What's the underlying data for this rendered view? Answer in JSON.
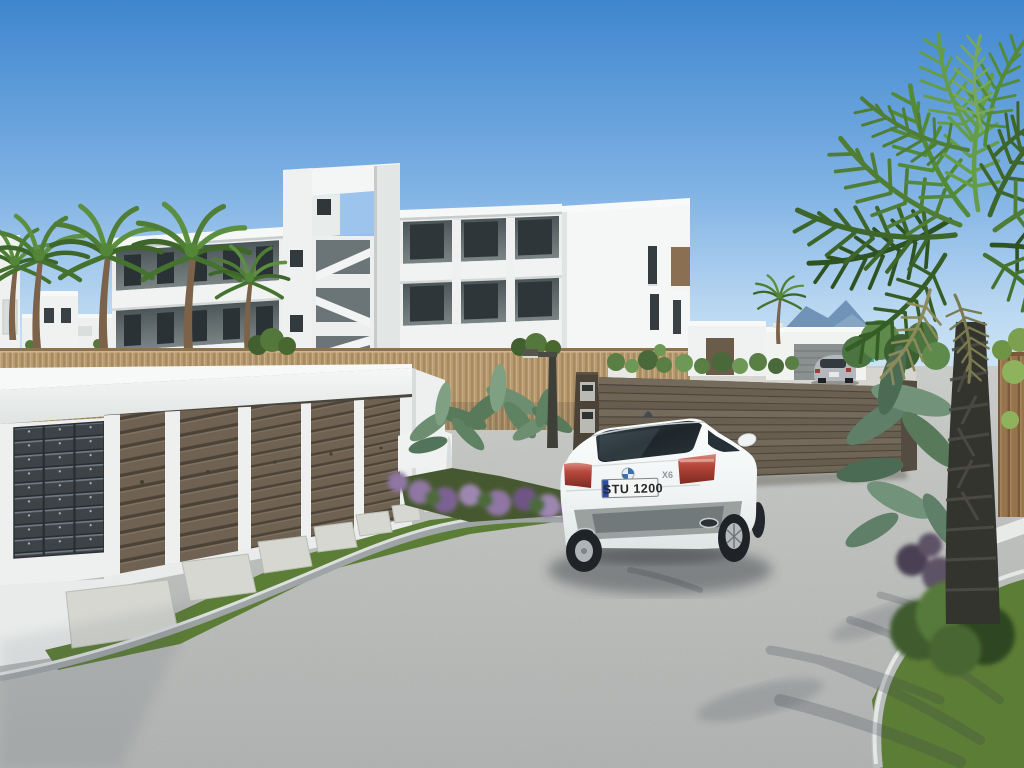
{
  "scene": {
    "description": "3D architectural rendering of a new-build Mediterranean residential complex: white three-storey apartment block with open stair tower and balconies, palm trees, reed privacy fence, garage block with post boxes and brown slatted doors, stepping-stone path on grass, gravel driveway where a white BMW X6 faces a brown slatted entrance gate; beyond the gate white villas, a parked silver coupe, cactus garden and distant blue mountains; large fan palm and tropical planting on the right.",
    "car": {
      "brand": "BMW",
      "model_badge": "X6",
      "license_plate": "STU 1200"
    },
    "distant_car": {
      "type": "silver coupe"
    },
    "colors": {
      "sky_top": "#3E86CE",
      "sky_horizon": "#D9EAF8",
      "building_white": "#F2F4F3",
      "balcony_recess": "#5E6769",
      "window_glass": "#2E3538",
      "reed_fence": "#B79B73",
      "garage_door_brown": "#6E6051",
      "mailbox_grey": "#3E4348",
      "entrance_gate_brown": "#6E6456",
      "gravel": "#B8BAB7",
      "grass": "#5C7D35",
      "paving_stone": "#D6D7D1",
      "palm_green": "#4F7D35",
      "palm_trunk": "#34342F",
      "mountains_blue": "#6D8FB3",
      "sea_teal": "#35A0AF",
      "car_white": "#F2F4F4",
      "taillight_red": "#B8493E",
      "plate_eu_strip_blue": "#2B4DA0"
    }
  }
}
